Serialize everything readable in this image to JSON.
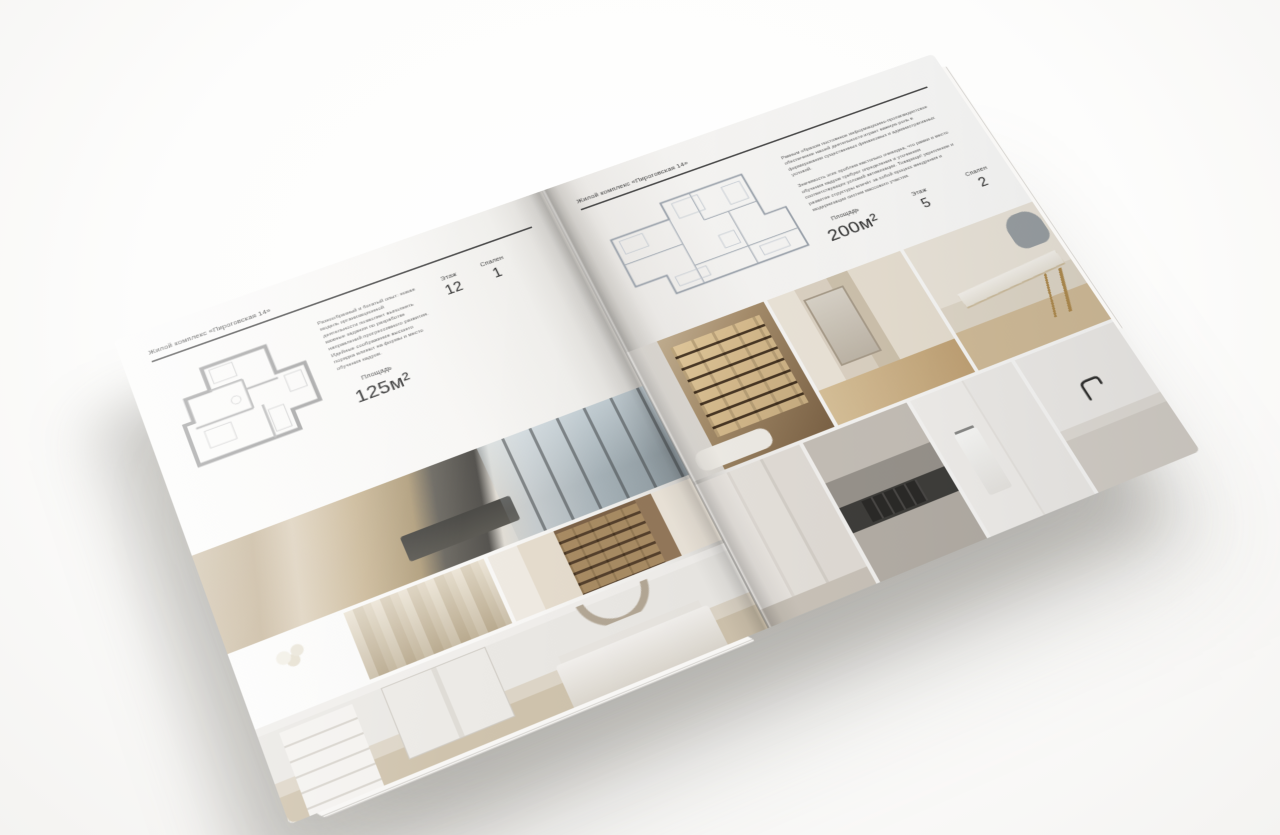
{
  "palette": {
    "paper": "#f7f6f4",
    "ink": "#3c3c3c",
    "rule": "#4a4a4a",
    "photo_beige": "#c9b79b",
    "photo_teal": "#2d403f",
    "photo_wood": "#7d6348"
  },
  "left_page": {
    "header": "Жилой комплекс «Пироговская 14»",
    "description": "Разнообразный и богатый опыт: новая модель организационной деятельности позволяет выполнять важные задания по разработке направлений прогрессивного развития. Идейные соображения высшего порядка влияют на формы и место обучения кадров.",
    "stats": {
      "area_label": "Площадь",
      "area_value": "125м²",
      "floor_label": "Этаж",
      "floor_value": "12",
      "bedrooms_label": "Спален",
      "bedrooms_value": "1"
    },
    "photos": [
      "master-bedroom-panorama",
      "console-with-flowers",
      "wardrobe-curtain-detail",
      "hallway-bookshelf",
      "white-bedroom"
    ]
  },
  "right_page": {
    "header": "Жилой комплекс «Пироговская 14»",
    "description_1": "Равным образом постоянное информационно-пропагандистское обеспечение нашей деятельности играет важную роль в формировании существенных финансовых и административных условий.",
    "description_2": "Значимость этих проблем настолько очевидна, что рамки и место обучения кадров требуют определения и уточнения соответствующих условий активизации. Товарищи! укрепление и развитие структуры влечёт за собой процесс внедрения и модернизации систем массового участия.",
    "stats": {
      "area_label": "Площадь",
      "area_value": "200м²",
      "floor_label": "Этаж",
      "floor_value": "5",
      "bedrooms_label": "Спален",
      "bedrooms_value": "2"
    },
    "photos": [
      "lit-wardrobe-bath",
      "vanity-room",
      "desk-with-gold-legs",
      "corridor-closets",
      "kitchen-cooktop-detail",
      "bathroom-towel",
      "sink-faucet"
    ]
  }
}
